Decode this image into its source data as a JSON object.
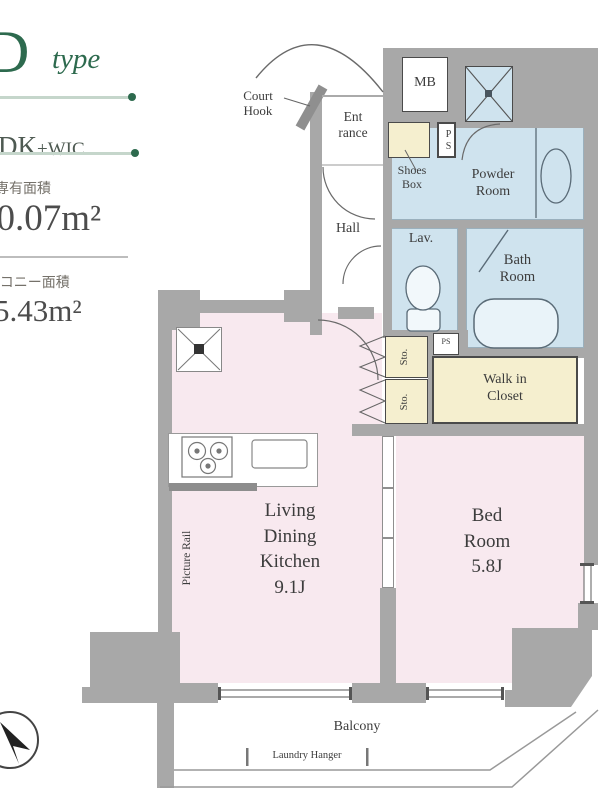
{
  "header": {
    "type_letter": "D",
    "type_suffix": "type",
    "layout_main": "DK",
    "layout_suffix": "+WIC",
    "area_label": "専有面積",
    "area_value": "30.07m²",
    "balcony_label": "バルコニー面積",
    "balcony_value": "5.43m²"
  },
  "plan": {
    "court_hook": "Court\nHook",
    "entrance": "Ent\nrance",
    "mb": "MB",
    "ps": "PS",
    "ps_small": "PS",
    "shoes_box": "Shoes\nBox",
    "powder_room": "Powder\nRoom",
    "hall": "Hall",
    "lav": "Lav.",
    "bath_room": "Bath\nRoom",
    "sto_upper": "Sto.",
    "sto_lower": "Sto.",
    "walk_in_closet": "Walk in\nCloset",
    "ldk": "Living\nDining\nKitchen\n9.1J",
    "bedroom": "Bed\nRoom\n5.8J",
    "picture_rail": "Picture Rail",
    "balcony": "Balcony",
    "laundry_hanger": "Laundry Hanger"
  },
  "colors": {
    "wall": "#a8a8a8",
    "room_pink": "#f8e9ef",
    "room_blue": "#cfe3ee",
    "room_cream": "#f5efcf",
    "accent_green": "#2d6a4e",
    "text_dark": "#3c3c3c"
  }
}
